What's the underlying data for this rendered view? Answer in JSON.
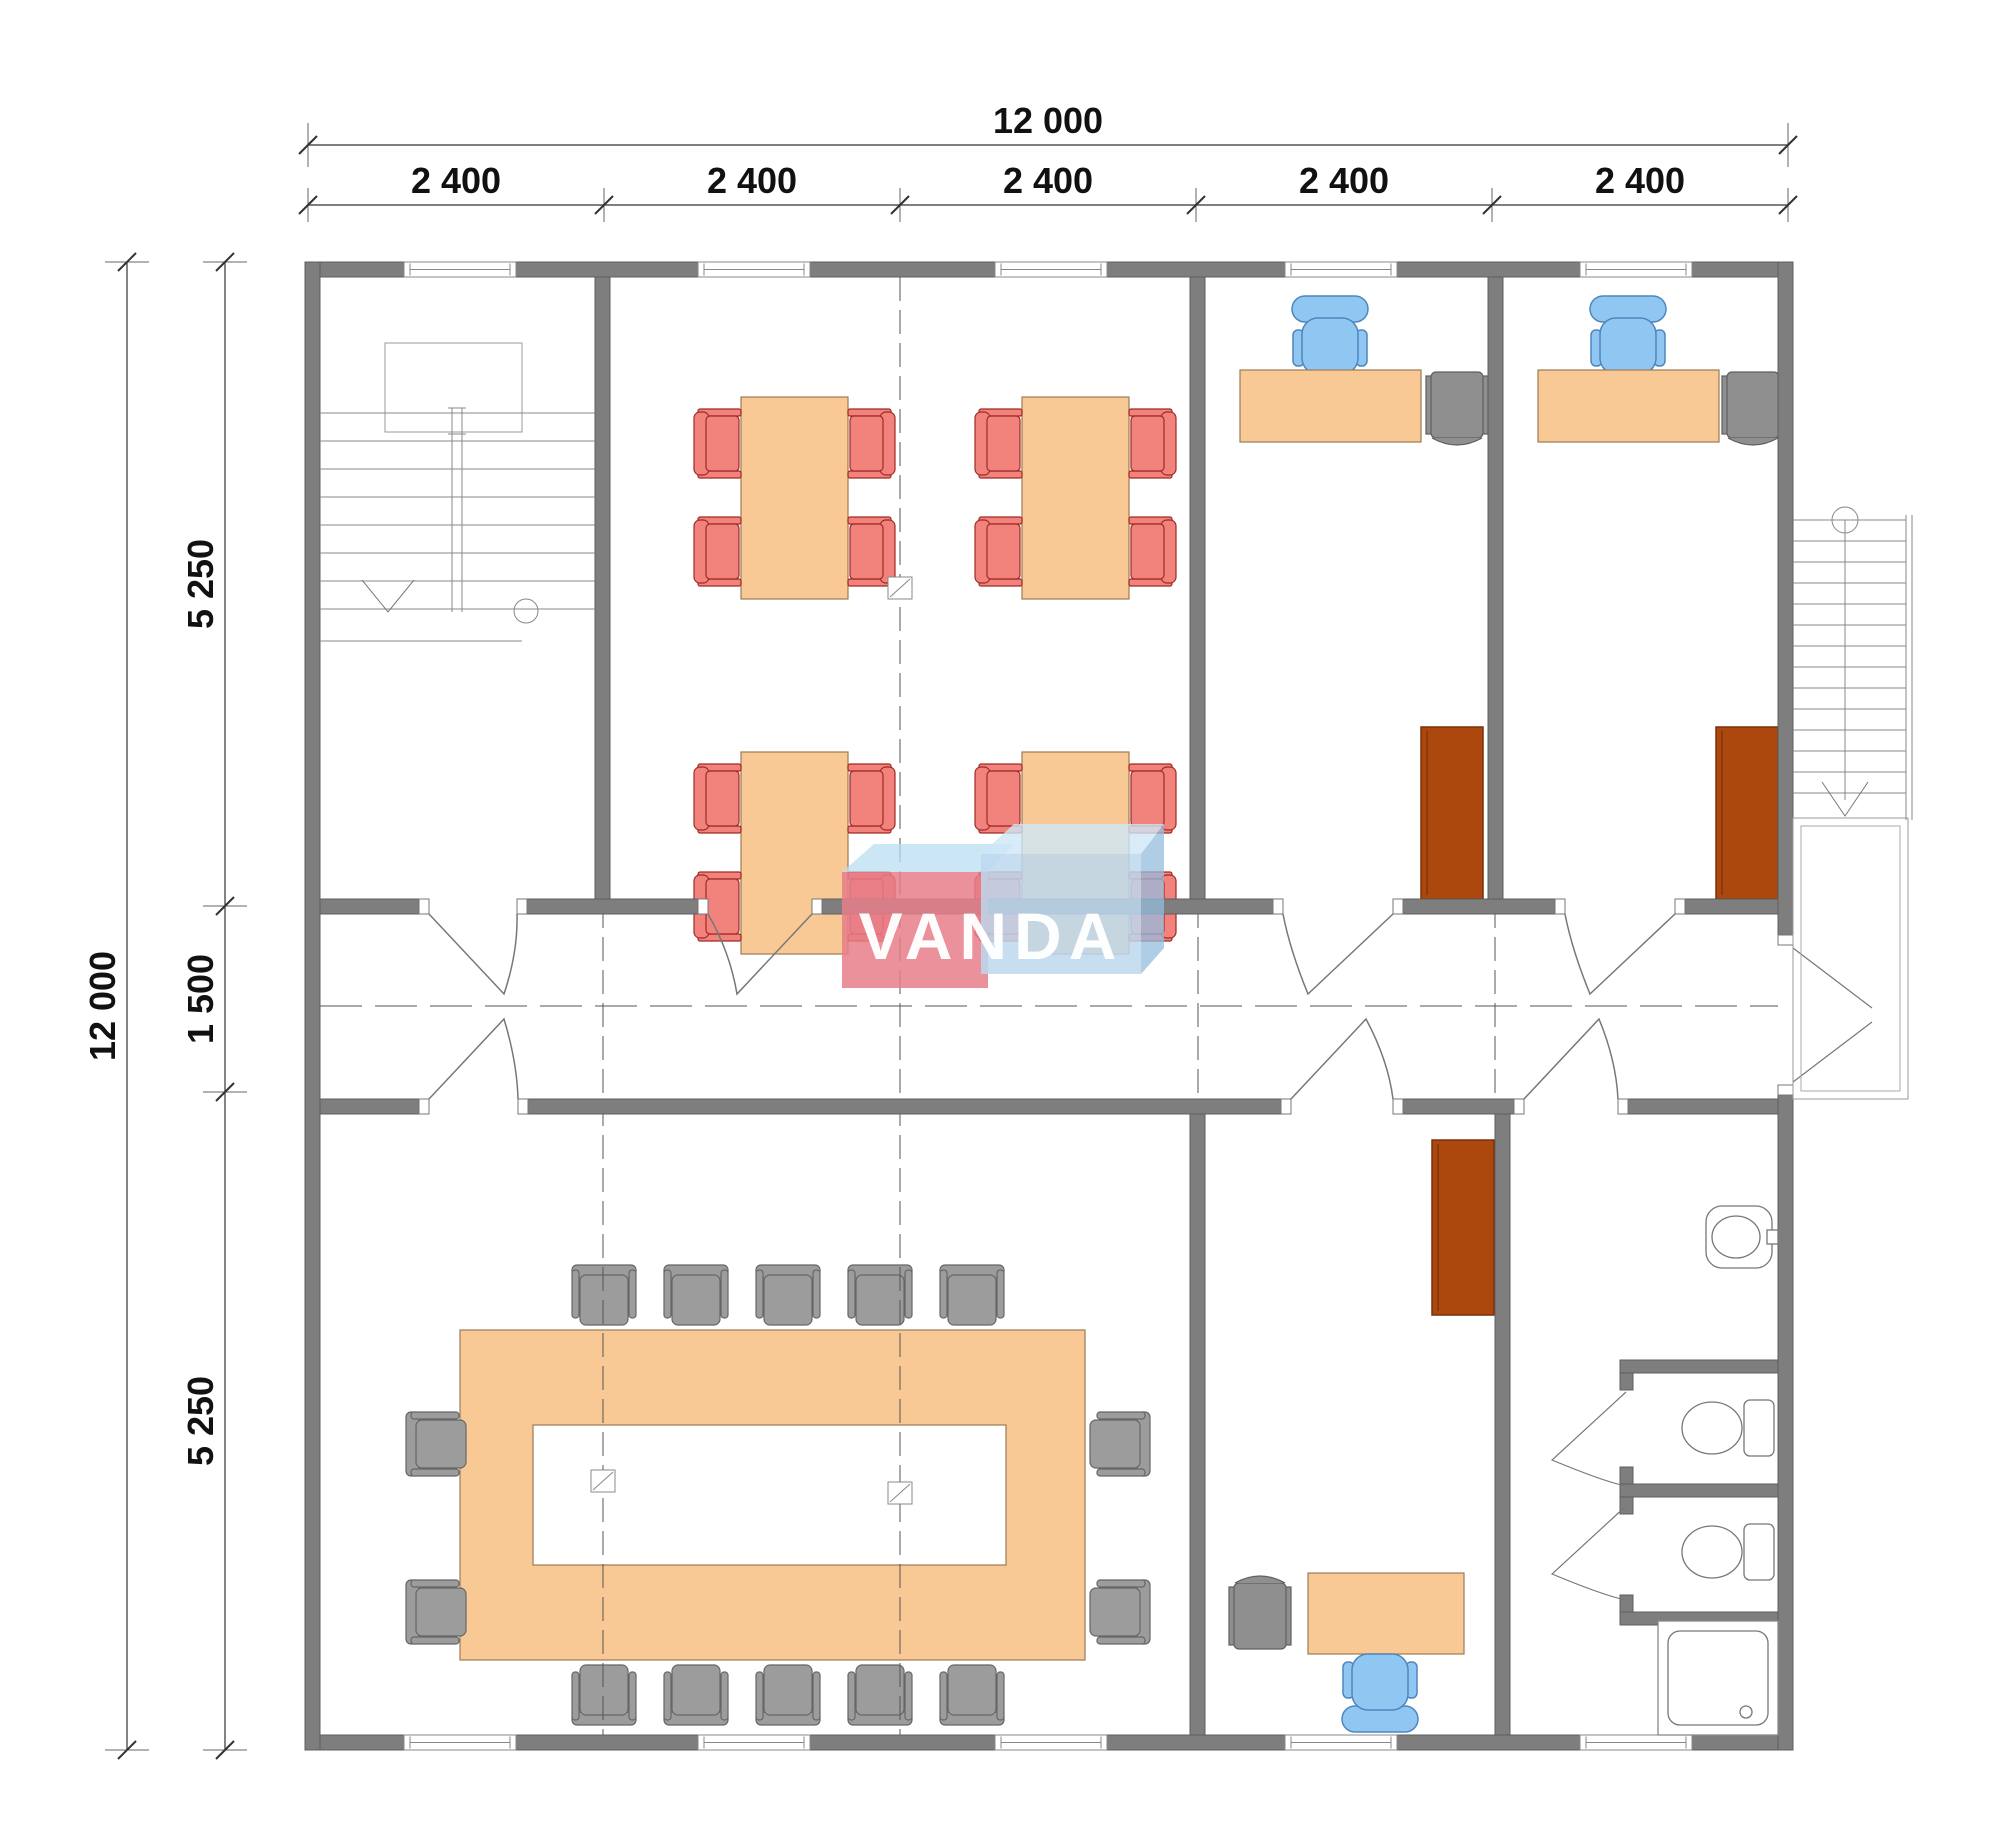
{
  "drawing": {
    "logo_text": "VANDA",
    "dim_top_total": "12 000",
    "dim_top_segments": [
      "2 400",
      "2 400",
      "2 400",
      "2 400",
      "2 400"
    ],
    "dim_left_total": "12 000",
    "dim_left_top": "5 250",
    "dim_left_middle": "1 500",
    "dim_left_bottom": "5 250",
    "colors": {
      "wall_gray": "#7e7e7e",
      "wall_outline": "#5f5f5f",
      "table_peach": "#f8c994",
      "table_outline": "#9c7b55",
      "chair_red": "#f2827c",
      "chair_red_outline": "#a02a24",
      "chair_gray": "#9c9c9c",
      "chair_gray_outline": "#666666",
      "chair_blue": "#90c7f2",
      "chair_blue_outline": "#4e86bd",
      "wardrobe_brown": "#ac480e",
      "wardrobe_outline": "#793009",
      "logo_pink": "rgba(232,126,137,0.85)",
      "logo_blue": "rgba(189,216,238,0.85)",
      "thin_line": "#777777",
      "dimension_line": "#333333"
    }
  }
}
